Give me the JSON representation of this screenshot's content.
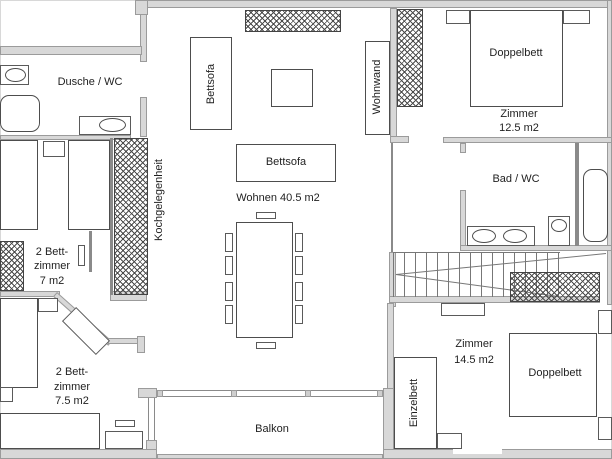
{
  "title": "Wohnungsgrundriss",
  "colors": {
    "wall_fill": "#d8d8d8",
    "wall_outline": "#9b9b9b",
    "furniture_line": "#4d4d4d",
    "hatch_line": "#4a4a4a",
    "text": "#1f1f1f",
    "background": "#ffffff"
  },
  "rooms": {
    "shower_wc": {
      "label": "Dusche / WC"
    },
    "kitchenette": {
      "label": "Kochgelegenheit"
    },
    "living": {
      "label": "Wohnen 40.5 m2"
    },
    "bedroom7": {
      "line1": "2 Bett-",
      "line2": "zimmer",
      "line3": "7 m2"
    },
    "bedroom75": {
      "line1": "2 Bett-",
      "line2": "zimmer",
      "line3": "7.5 m2"
    },
    "room125": {
      "line1": "Zimmer",
      "line2": "12.5 m2"
    },
    "bath_wc": {
      "label": "Bad / WC"
    },
    "room145": {
      "line1": "Zimmer",
      "line2": "14.5 m2"
    },
    "balcony": {
      "label": "Balkon"
    }
  },
  "furniture": {
    "sofa_bed_left": "Bettsofa",
    "sofa_bed_center": "Bettsofa",
    "wall_unit": "Wohnwand",
    "double_bed_top": "Doppelbett",
    "double_bed_bottom": "Doppelbett",
    "single_bed": "Einzelbett"
  }
}
